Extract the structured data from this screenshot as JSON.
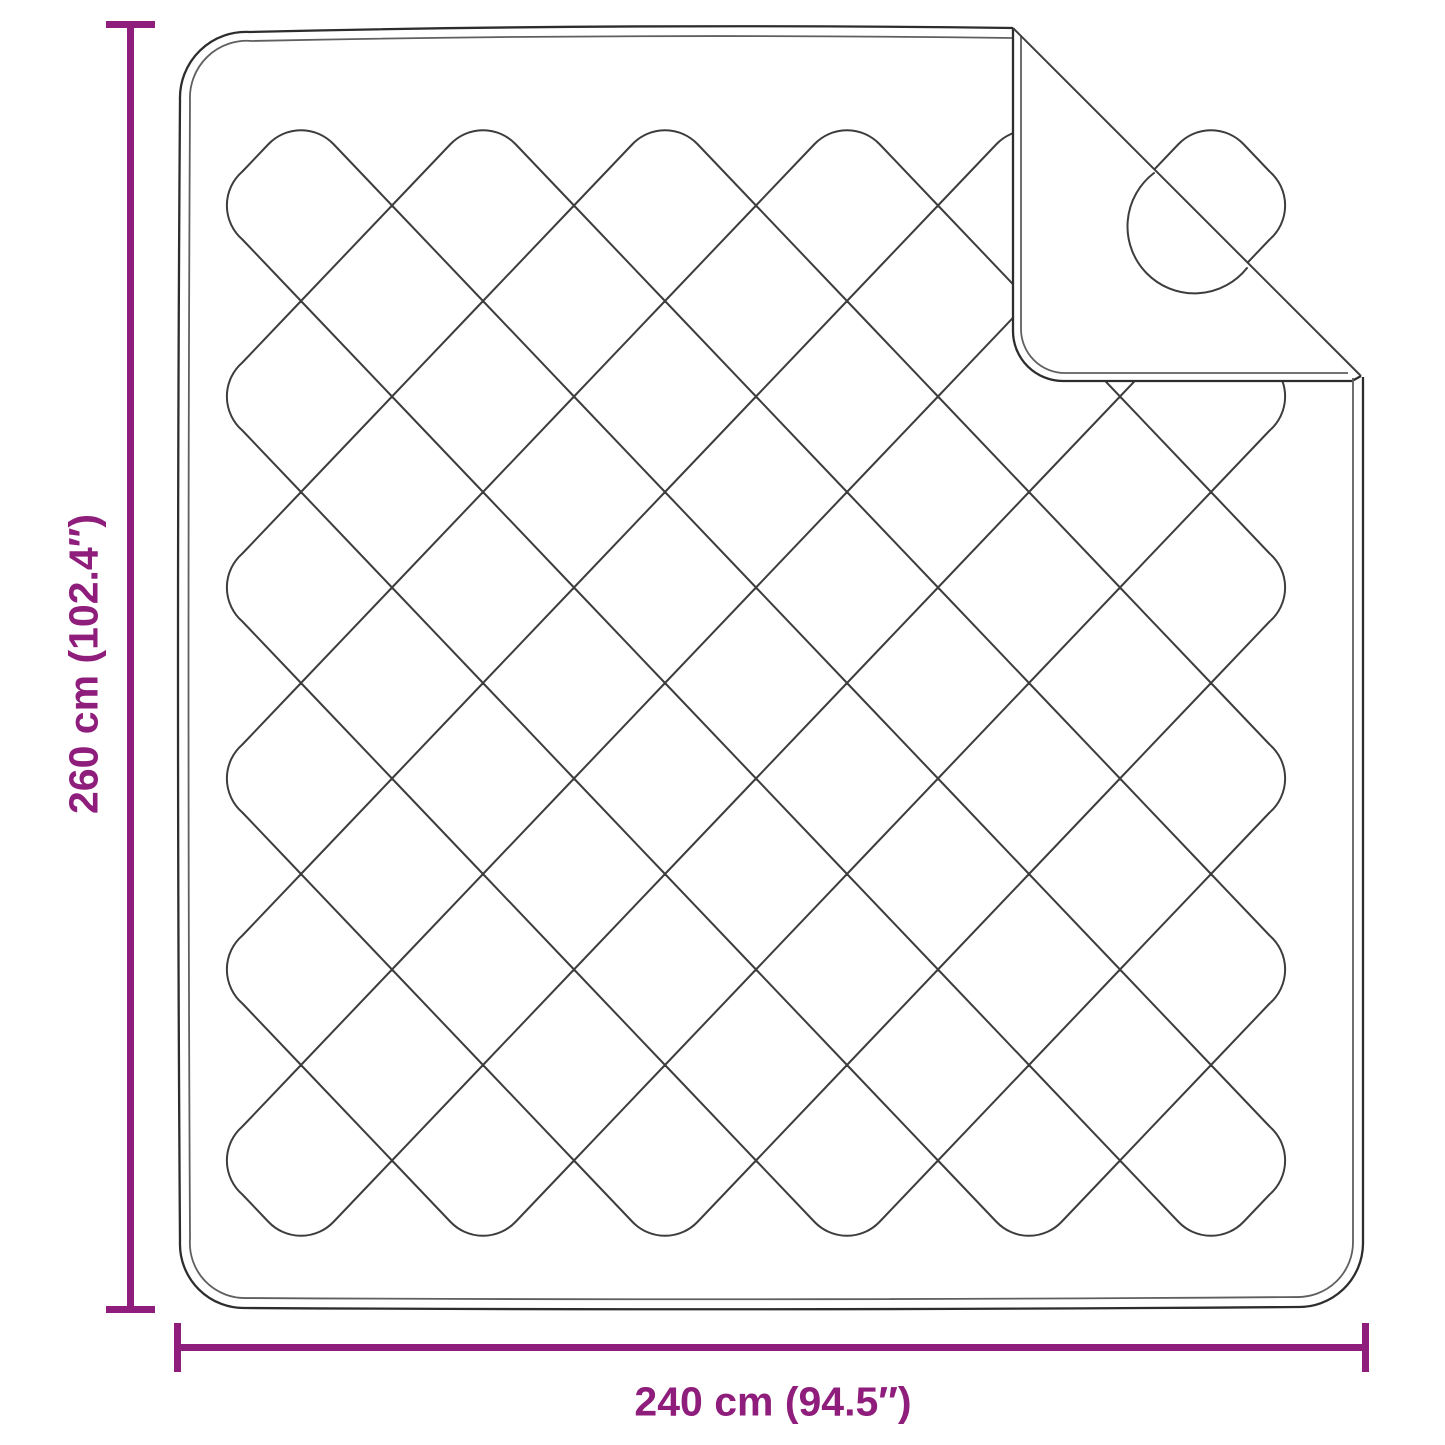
{
  "diagram": {
    "subject": "quilted-blanket-top-view",
    "height_dimension": {
      "label": "260 cm (102.4″)",
      "value_cm": 260,
      "value_inch": 102.4
    },
    "width_dimension": {
      "label": "240 cm (94.5″)",
      "value_cm": 240,
      "value_inch": 94.5
    }
  },
  "colors": {
    "dimension_accent": "#8e1d7b",
    "stitch_line": "#3d3d3d",
    "outline": "#2d2d2d",
    "outline_inner": "#5f5f5f",
    "background": "#ffffff"
  }
}
